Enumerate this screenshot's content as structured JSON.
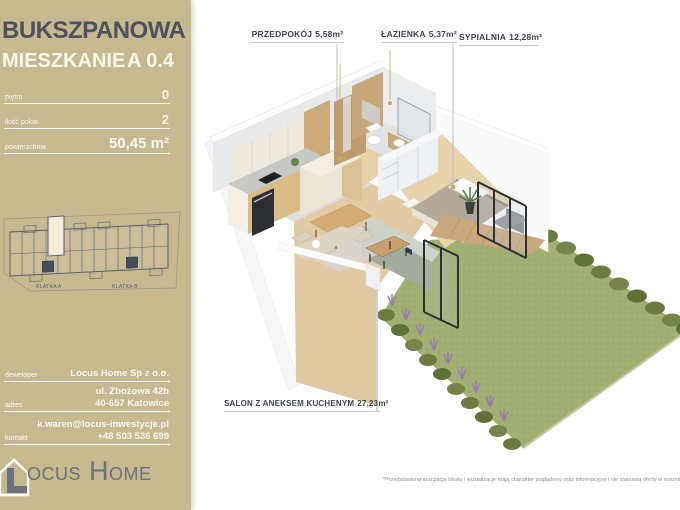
{
  "sidebar": {
    "project": "BUKSZPANOWA",
    "unit_label": "MIESZKANIE",
    "unit_number": "A 0.4",
    "specs": [
      {
        "label": "piętro",
        "value": "0"
      },
      {
        "label": "ilość pokoi",
        "value": "2"
      },
      {
        "label": "powierzchnia",
        "value": "50,45 m²"
      }
    ],
    "minimap": {
      "klatka_a": "KLATKA A",
      "klatka_b": "KLATKA B"
    },
    "contact": [
      {
        "label": "deweloper",
        "lines": [
          "Locus Home Sp z o.o."
        ]
      },
      {
        "label": "adres",
        "lines": [
          "ul. Zbożowa 42b",
          "40-657 Katowice"
        ]
      },
      {
        "label": "kontakt",
        "lines": [
          "k.waren@locus-inwestycje.pl",
          "+48 503 536 699"
        ]
      }
    ],
    "logo": {
      "word1_initial": "L",
      "word1_rest": "OCUS",
      "word2_initial": "H",
      "word2_rest": "OME"
    }
  },
  "plan": {
    "rooms": [
      {
        "name": "PRZEDPOKÓJ",
        "area": "5,58m²"
      },
      {
        "name": "ŁAZIENKA",
        "area": "5,37m²"
      },
      {
        "name": "SYPIALNIA",
        "area": "12,28m²"
      },
      {
        "name": "SALON Z ANEKSEM KUCHENYM",
        "area": "27,23m²"
      }
    ]
  },
  "footer": {
    "disclaimer": "*Przedstawiona aranżacja lokalu i wizualizacje mają charakter poglądowy oraz informacyjny i nie stanowią oferty w rozumieniu Kodeksu Cywilnego"
  },
  "colors": {
    "sidebar_bg": "#c6b88f",
    "title": "#4c515d",
    "text_white": "#faf7ec",
    "minimap_outline": "#596070",
    "minimap_highlight": "#f3edda",
    "label_text": "#40454f",
    "grass": "#a2af73",
    "hedge": "#6c7c41",
    "lavender": "#9b79b2",
    "wood_floor": "#e1caa3",
    "deck_wood": "#c9a87c",
    "wall_gray": "#e8e9eb",
    "lamp_gold": "#c9a84f"
  }
}
